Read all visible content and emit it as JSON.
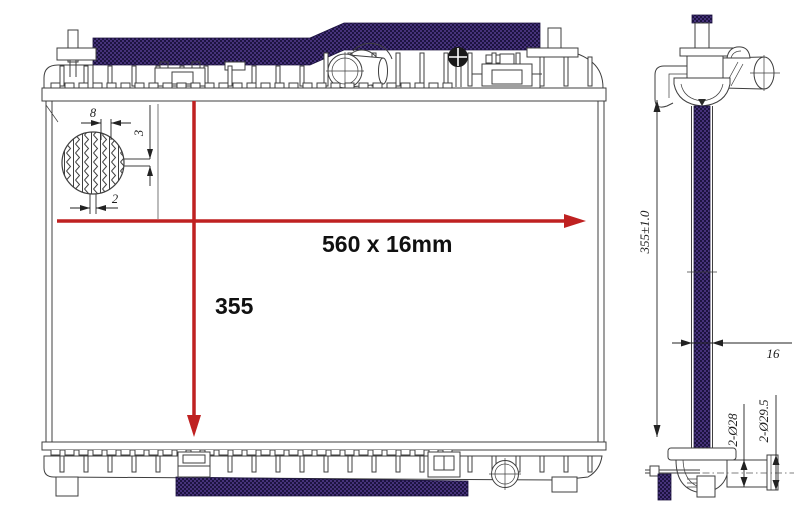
{
  "title": "Radiator technical drawing",
  "front_view": {
    "width_dimension_label": "560 x 16mm",
    "height_dimension_label": "355",
    "detail_callout": {
      "tube_pitch_label": "8",
      "fin_height_label": "3",
      "tube_thickness_label": "2"
    }
  },
  "side_view": {
    "core_height_label": "355±1.0",
    "core_thickness_label": "16",
    "pipe_inner_diameter_label": "2-Ø28",
    "pipe_outer_diameter_label": "2-Ø29.5"
  },
  "colors": {
    "dimension_red": "#bf2121",
    "core_hatch_purple": "#46327a",
    "core_hatch_dark": "#1c1340",
    "line": "#3f3f3f"
  }
}
